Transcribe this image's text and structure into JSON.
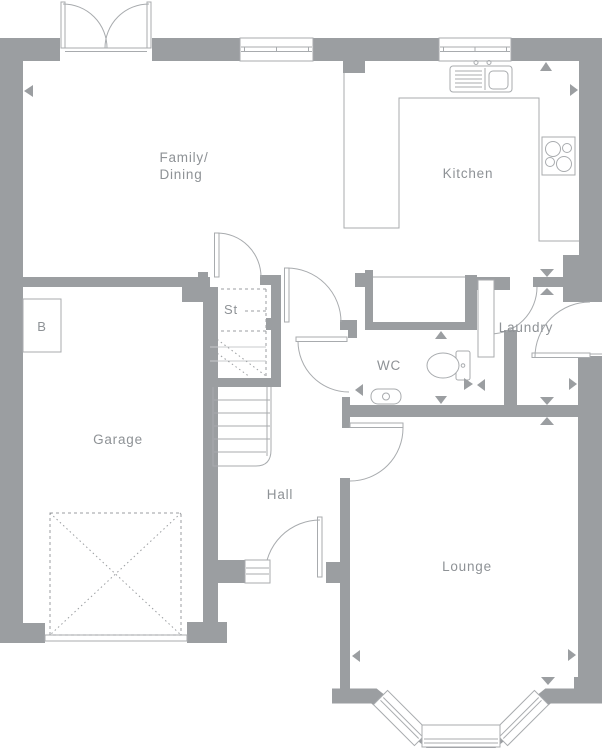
{
  "plan": {
    "type": "ground-floor-plan",
    "labels": {
      "family_line1": "Family/",
      "family_line2": "Dining",
      "kitchen": "Kitchen",
      "store": "St",
      "boiler": "B",
      "garage": "Garage",
      "hall": "Hall",
      "wc": "WC",
      "laundry": "Laundry",
      "lounge": "Lounge"
    },
    "fixtures": [
      "french-doors",
      "window",
      "window",
      "sink",
      "hob",
      "worktop",
      "toilet",
      "basin",
      "stairs",
      "understairs-store",
      "boiler",
      "garage-door",
      "front-door-step",
      "bay-window"
    ],
    "colors": {
      "wall": "#9b9ea1",
      "line": "#a8abae",
      "faint": "#c9cbcd",
      "label": "#8e9296",
      "bg": "#ffffff"
    }
  }
}
